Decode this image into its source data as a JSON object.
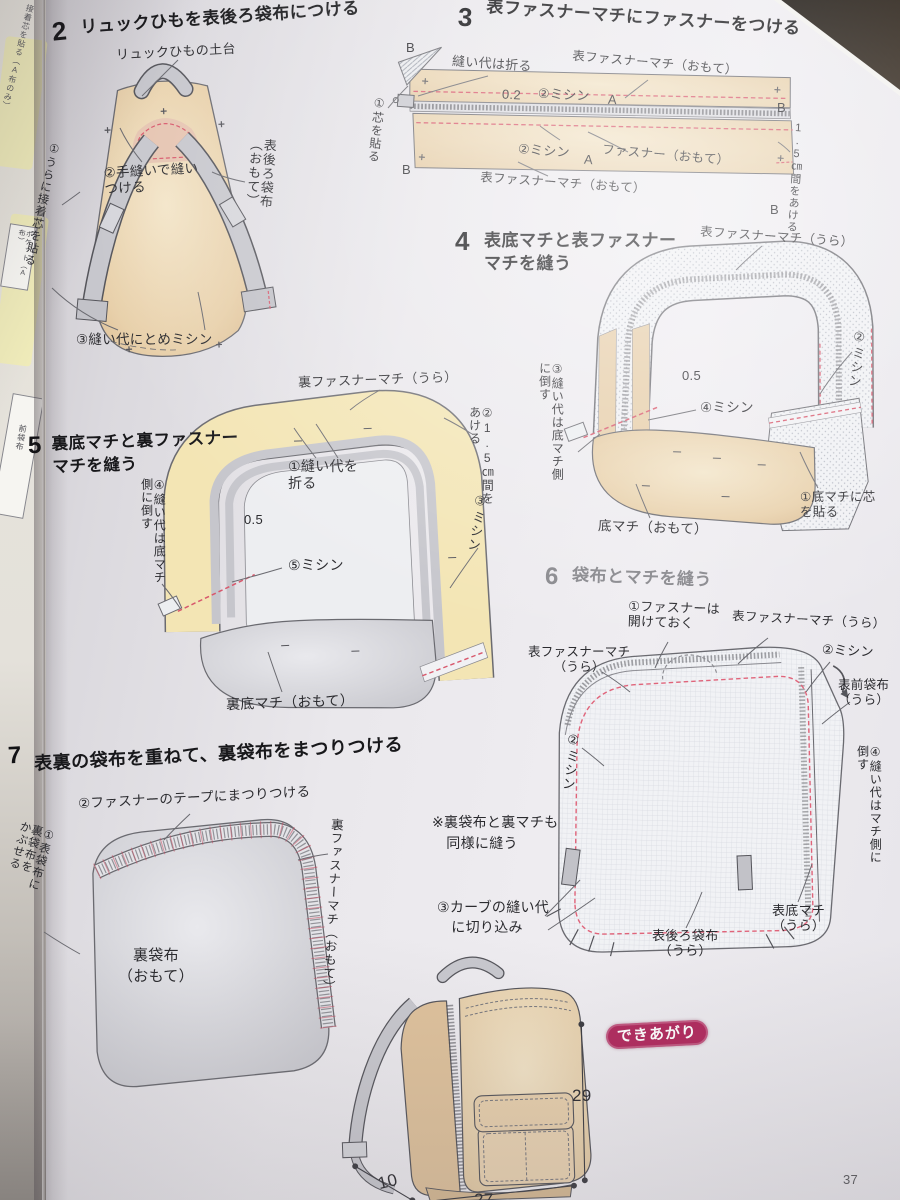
{
  "page": {
    "number": "37"
  },
  "left_page": {
    "top_note": "接着芯を貼る（A布のみ）",
    "box1": "ポケット（A布）",
    "box2": "前袋布"
  },
  "step2": {
    "num": "2",
    "title": "リュックひもを表後ろ袋布につける",
    "strap_base": "リュックひもの土台",
    "hand_sew": "②手縫いで縫い\nつける",
    "back_fabric": "表後ろ袋布\n（おもて）",
    "interfacing": "①うらに接着芯を貼る",
    "tack_stitch": "③縫い代にとめミシン"
  },
  "step3": {
    "num": "3",
    "title": "表ファスナーマチにファスナーをつける",
    "fold_allowance": "縫い代は折る",
    "gusset_top": "表ファスナーマチ（おもて）",
    "gap_02": "0.2",
    "stitch_top": "②ミシン",
    "mark_a": "A",
    "stitch_bottom": "②ミシン",
    "zipper": "ファスナー（おもて）",
    "gusset_bottom": "表ファスナーマチ（おもて）",
    "interfacing": "①芯を貼る",
    "gap_note": "1.5㎝間をあける",
    "mark_b": "B"
  },
  "step4": {
    "num": "4",
    "title": "表底マチと表ファスナー\nマチを縫う",
    "gusset": "表ファスナーマチ（うら）",
    "stitch2": "②ミシン",
    "press": "③縫い代は底マチ側\nに倒す",
    "gap_05": "0.5",
    "stitch4": "④ミシン",
    "bottom_gusset": "底マチ（おもて）",
    "interfacing": "①底マチに芯\nを貼る"
  },
  "step5": {
    "num": "5",
    "title": "裏底マチと裏ファスナー\nマチを縫う",
    "gusset": "裏ファスナーマチ（うら）",
    "gap": "②1.5㎝間を\nあける",
    "fold": "①縫い代を\n折る",
    "stitch3": "③ミシン",
    "gap_05": "0.5",
    "stitch5": "⑤ミシン",
    "press": "④縫い代は底マチ\n側に倒す",
    "bottom_gusset": "裏底マチ（おもて）"
  },
  "step6": {
    "num": "6",
    "title": "袋布とマチを縫う",
    "zipper_open": "①ファスナーは\n開けておく",
    "gusset_right": "表ファスナーマチ（うら）",
    "gusset_left": "表ファスナーマチ\n（うら）",
    "stitch2_right": "②ミシン",
    "front_fabric": "表前袋布\n（うら）",
    "stitch2_left": "②ミシン",
    "note": "※裏袋布と裏マチも\n　同様に縫う",
    "clip_curves": "③カーブの縫い代\n　に切り込み",
    "back_fabric": "表後ろ袋布\n（うら）",
    "bottom_gusset": "表底マチ\n（うら）",
    "press": "④縫い代はマチ側に\n倒す"
  },
  "step7": {
    "num": "7",
    "title": "表裏の袋布を重ねて、裏袋布をまつりつける",
    "slip_stitch": "②ファスナーのテープにまつりつける",
    "lining_gusset": "裏ファスナーマチ（おもて）",
    "lining_bag": "裏袋布\n（おもて）",
    "cover": "①表袋布に\n裏袋布を\nかぶせる"
  },
  "finished": {
    "badge": "できあがり",
    "height": "29",
    "width": "27",
    "depth": "10"
  },
  "colors": {
    "accent_badge": "#b12a5e",
    "stitch_red": "#e06a78",
    "fabric_tan": "#e4caa5",
    "fabric_cream": "#f3e5b4",
    "fabric_gray": "#c9c9ce"
  }
}
